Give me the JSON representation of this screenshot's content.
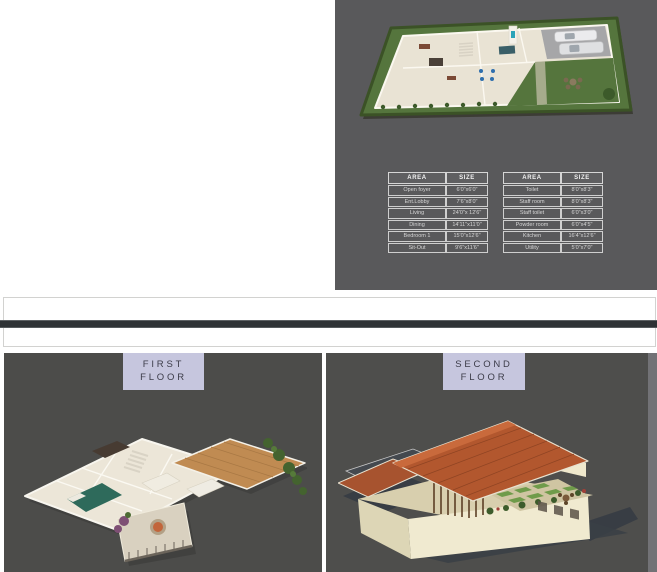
{
  "ground_floor_sheet": {
    "description": "Ground floor 3D plan sheet",
    "area_tables": [
      {
        "headers": [
          "AREA",
          "SIZE"
        ],
        "rows": [
          [
            "Open foyer",
            "6'0\"x6'0\""
          ],
          [
            "Ent.Lobby",
            "7'6\"x8'0\""
          ],
          [
            "Living",
            "24'0\"x 12'6\""
          ],
          [
            "Dining",
            "14'11\"x11'0\""
          ],
          [
            "Bedroom 1",
            "15'0\"x12'6\""
          ],
          [
            "Sit-Out",
            "9'6\"x11'6\""
          ]
        ]
      },
      {
        "headers": [
          "AREA",
          "SIZE"
        ],
        "rows": [
          [
            "Toilet",
            "8'0\"x8'3\""
          ],
          [
            "Staff room",
            "8'0\"x8'3\""
          ],
          [
            "Staff toilet",
            "6'0\"x3'0\""
          ],
          [
            "Powder room",
            "6'0\"x4'5\""
          ],
          [
            "Kitchen",
            "16'4\"x12'6\""
          ],
          [
            "Utility",
            "5'0\"x7'0\""
          ]
        ]
      }
    ]
  },
  "floor_sections": [
    {
      "label_lines": [
        "FIRST",
        "FLOOR"
      ]
    },
    {
      "label_lines": [
        "SECOND",
        "FLOOR"
      ]
    }
  ],
  "colors": {
    "sheet_bg": "#59595b",
    "panel_first_bg": "#4c4c4a",
    "panel_second_bg": "#4e4e4c",
    "right_strip": "#727276",
    "divider_dark": "#2f3336",
    "frame_border": "#d2d2d0",
    "label_bg": "#c6c6de",
    "label_text": "#3c3c49",
    "table_border": "#d6d6d6",
    "table_header_text": "#f2f2f2",
    "table_cell_text": "#d6d6d6",
    "lawn_green": "#55753d",
    "floor_cream": "#ebe5d6",
    "wood_floor": "#c08b52",
    "roof_terracotta": "#b2572e"
  }
}
